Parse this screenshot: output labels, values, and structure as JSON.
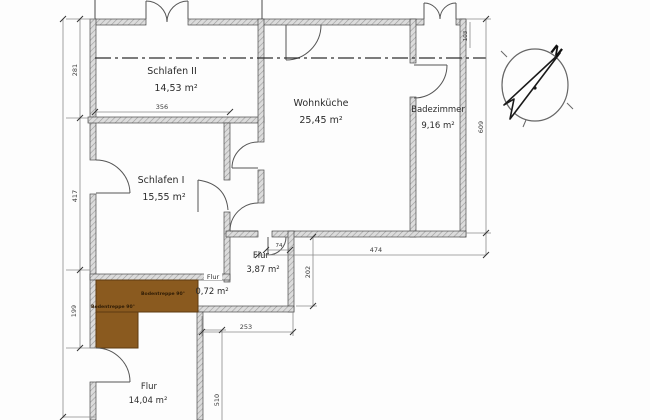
{
  "plan": {
    "title": "Grundriss Wohnung",
    "rooms": {
      "schlafen2": {
        "name": "Schlafen II",
        "area": "14,53 m²"
      },
      "wohnkueche": {
        "name": "Wohnküche",
        "area": "25,45 m²"
      },
      "badezimmer": {
        "name": "Badezimmer",
        "area": "9,16 m²"
      },
      "schlafen1": {
        "name": "Schlafen I",
        "area": "15,55 m²"
      },
      "flur_klein": {
        "name": "Flur",
        "area": "3,87 m²"
      },
      "flur_mini": {
        "name": "Flur",
        "area": "0,72 m²"
      },
      "flur_gross": {
        "name": "Flur",
        "area": "14,04 m²"
      }
    },
    "stairs": {
      "label_upper": "Bodentreppe 90°",
      "label_lower": "Bodentreppe 90°",
      "color": "#8a5a1f"
    },
    "dims": {
      "d281": "281",
      "d356": "356",
      "d417": "417",
      "d199": "199",
      "d103": "103",
      "d609": "609",
      "d474": "474",
      "d74": "74",
      "d202": "202",
      "d253": "253",
      "d510": "510"
    },
    "compass": {
      "north": "N"
    },
    "colors": {
      "wall_fill": "#d6d6d6",
      "wall_hatch": "#9b9b9b",
      "line": "#4a4a4a",
      "stairs": "#8a5a1f"
    }
  }
}
